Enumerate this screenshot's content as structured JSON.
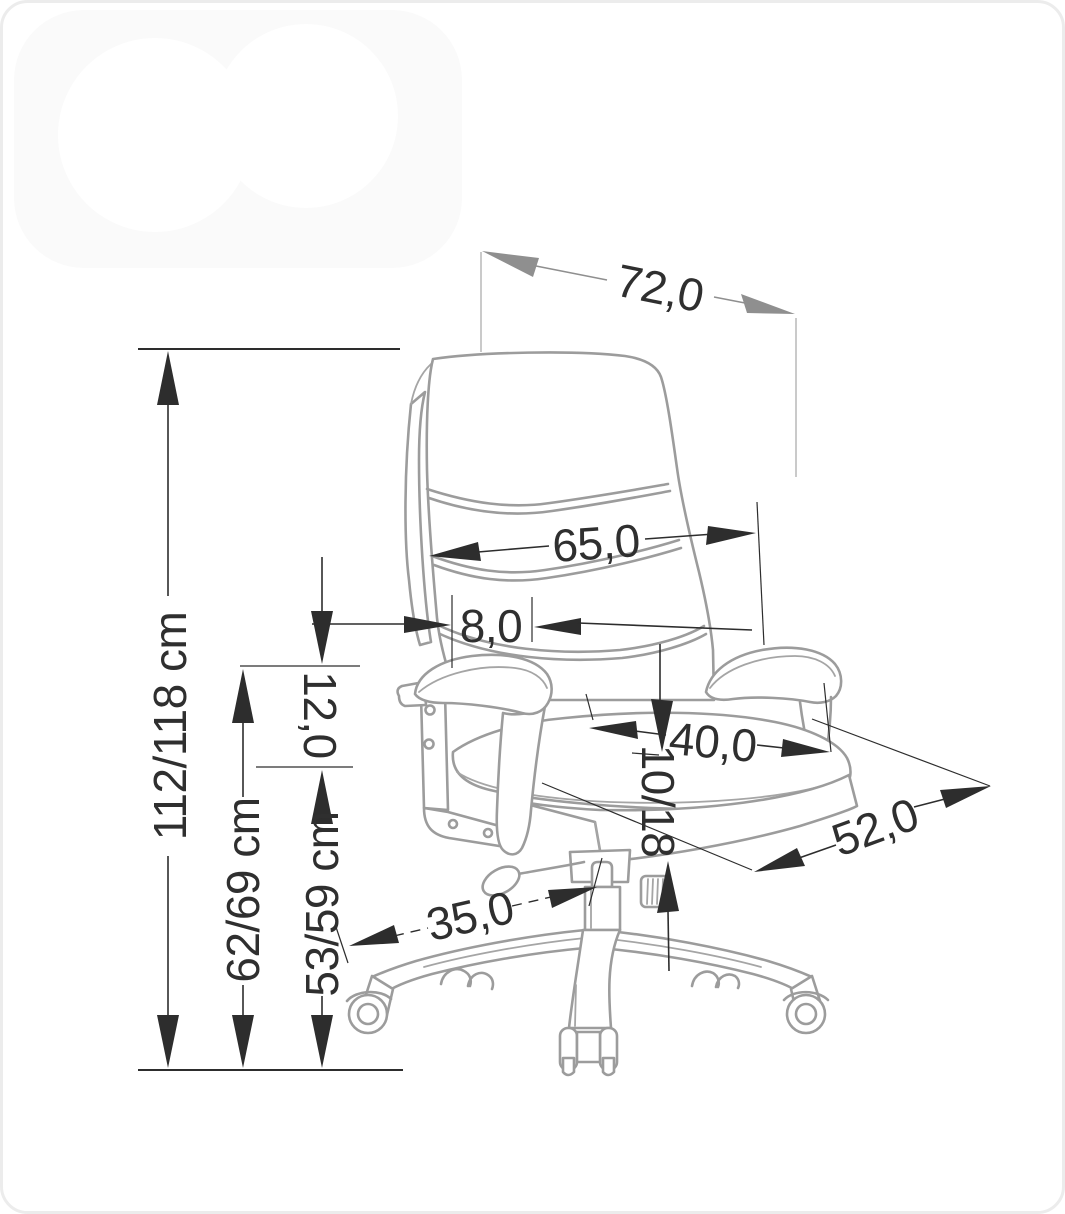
{
  "diagram": {
    "type": "product dimension drawing",
    "subject": "office swivel chair line drawing with dimension arrows",
    "unit_suffix": "cm"
  },
  "dimensions": {
    "overall_width": "72,0",
    "backrest_width": "65,0",
    "backrest_gap": "8,0",
    "armrest_rise": "12,0",
    "seat_width": "40,0",
    "seat_thickness": "10/18",
    "seat_depth": "52,0",
    "base_reach": "35,0",
    "total_height": "112/118 cm",
    "armrest_height": "62/69 cm",
    "seat_height": "53/59 cm"
  },
  "colors": {
    "background": "#ffffff",
    "chair_outline": "#9c9c9c",
    "dimension_lines": "#2d2d2d",
    "dimension_lines_gray": "#8f8f8f",
    "extension_lines": "#b9b9b9",
    "text": "#2f2f2f",
    "border": "#ececec",
    "watermark": "#fafafa"
  }
}
